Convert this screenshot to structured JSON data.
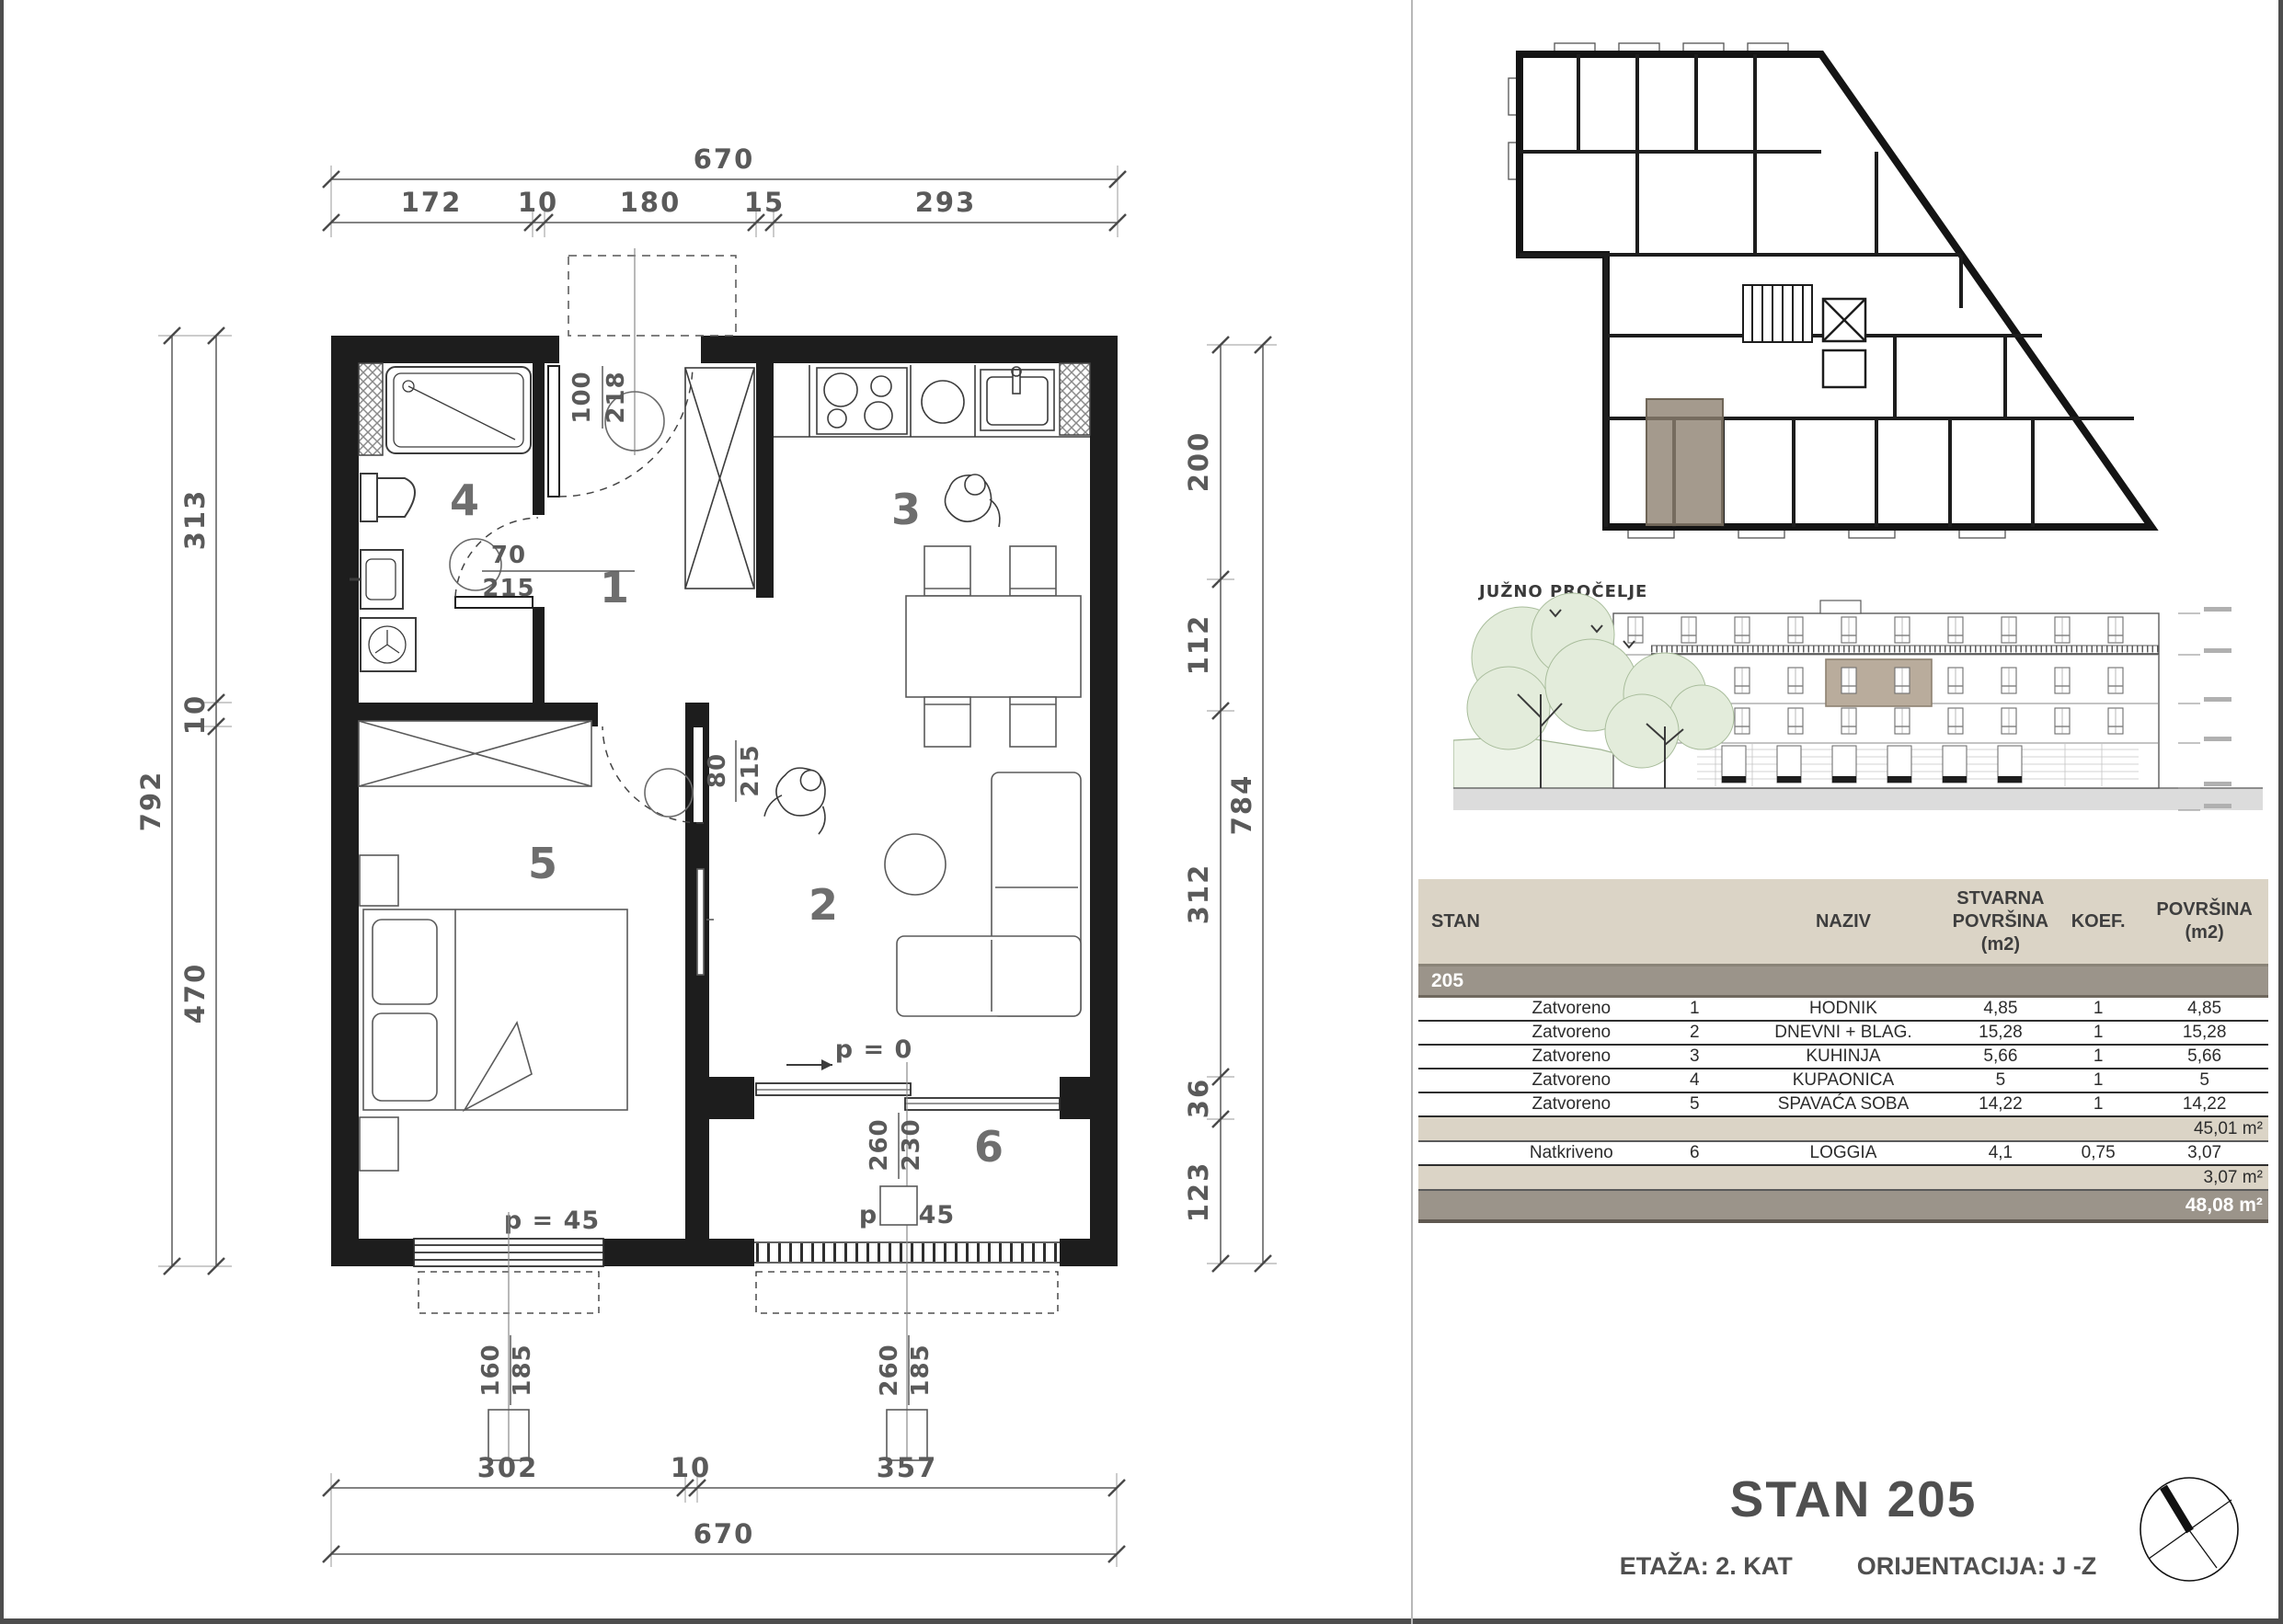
{
  "plan": {
    "rooms": {
      "hall": "1",
      "living": "2",
      "kitchen": "3",
      "bath": "4",
      "bedroom": "5",
      "loggia": "6"
    },
    "dims": {
      "top_total": "670",
      "top": [
        "172",
        "10",
        "180",
        "15",
        "293"
      ],
      "left_total": "792",
      "left": [
        "313",
        "10",
        "470"
      ],
      "right": [
        "200",
        "112",
        "312",
        "36",
        "123"
      ],
      "right_total": "784",
      "bottom": [
        "302",
        "10",
        "357"
      ],
      "bottom_total": "670"
    },
    "doors": {
      "entrance": {
        "w": "100",
        "h": "218"
      },
      "bath": {
        "w": "70",
        "h": "215"
      },
      "bedroom": {
        "w": "80",
        "h": "215"
      }
    },
    "windows": {
      "bedroom": {
        "w": "160",
        "h": "185",
        "p": "p = 45"
      },
      "loggia": {
        "w": "260",
        "h": "185",
        "p": "p = 45"
      },
      "balcony": {
        "w": "260",
        "h": "230",
        "p": "p = 0"
      }
    }
  },
  "elevation": {
    "label": "JUŽNO PROČELJE"
  },
  "table": {
    "headers": {
      "stan": "STAN",
      "naziv": "NAZIV",
      "stvarna_lines": [
        "STVARNA",
        "POVRŠINA",
        "(m2)"
      ],
      "koef": "KOEF.",
      "povrsina_lines": [
        "POVRŠINA",
        "(m2)"
      ]
    },
    "unit": "205",
    "rows": [
      {
        "type": "Zatvoreno",
        "num": "1",
        "name": "HODNIK",
        "area": "4,85",
        "koef": "1",
        "result": "4,85"
      },
      {
        "type": "Zatvoreno",
        "num": "2",
        "name": "DNEVNI + BLAG.",
        "area": "15,28",
        "koef": "1",
        "result": "15,28"
      },
      {
        "type": "Zatvoreno",
        "num": "3",
        "name": "KUHINJA",
        "area": "5,66",
        "koef": "1",
        "result": "5,66"
      },
      {
        "type": "Zatvoreno",
        "num": "4",
        "name": "KUPAONICA",
        "area": "5",
        "koef": "1",
        "result": "5"
      },
      {
        "type": "Zatvoreno",
        "num": "5",
        "name": "SPAVAĆA SOBA",
        "area": "14,22",
        "koef": "1",
        "result": "14,22"
      },
      {
        "type": "Natkriveno",
        "num": "6",
        "name": "LOGGIA",
        "area": "4,1",
        "koef": "0,75",
        "result": "3,07"
      }
    ],
    "subtotal_closed": "45,01 m²",
    "subtotal_covered": "3,07 m²",
    "total": "48,08 m²"
  },
  "title": {
    "stan": "STAN 205",
    "etaza": "ETAŽA: 2. KAT",
    "orijentacija": "ORIJENTACIJA: J -Z"
  },
  "colors": {
    "wall": "#1d1d1d",
    "dim_text": "#5a5a5a",
    "table_header_bg": "#dbd4c6",
    "band_bg": "#9b948a",
    "unit_highlight": "#8d8171",
    "tree_fill": "#e3ecdb",
    "ground": "#dcdcdc"
  }
}
